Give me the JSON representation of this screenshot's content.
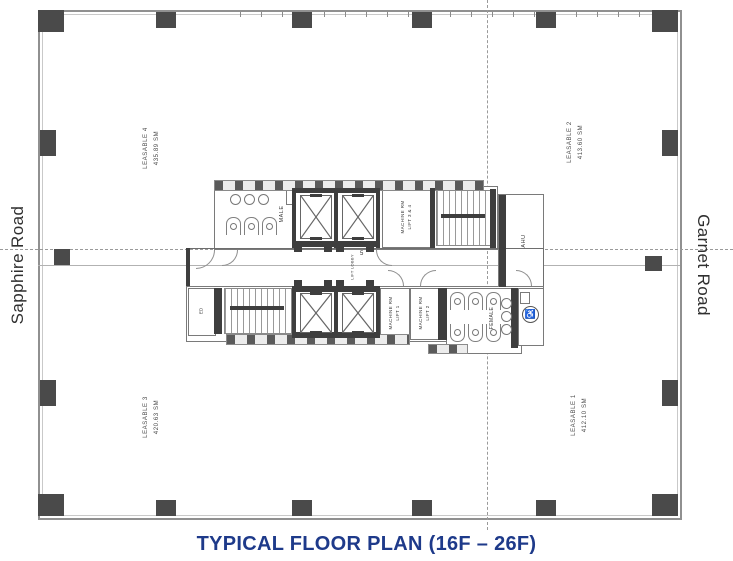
{
  "roads": {
    "left": "Sapphire Road",
    "right": "Garnet Road"
  },
  "title": {
    "text": "TYPICAL FLOOR PLAN (16F – 26F)"
  },
  "quadrants": {
    "top_left": {
      "name": "LEASABLE 4",
      "area": "435.89 SM"
    },
    "top_right": {
      "name": "LEASABLE 2",
      "area": "413.60 SM"
    },
    "bottom_left": {
      "name": "LEASABLE 3",
      "area": "420.63 SM"
    },
    "bottom_right": {
      "name": "LEASABLE 1",
      "area": "412.10 SM"
    }
  },
  "core": {
    "male": "MALE",
    "female": "FEMALE",
    "ahu": "AHU",
    "ed": "ED",
    "lift_lobby": "LIFT LOBBY",
    "stair_number": "5",
    "machine_rm_34": {
      "line1": "MACHINE RM",
      "line2": "LIFT 3 & 4"
    },
    "machine_rm_1": {
      "line1": "MACHINE RM",
      "line2": "LIFT 1"
    },
    "machine_rm_2": {
      "line1": "MACHINE RM",
      "line2": "LIFT 2"
    }
  },
  "colors": {
    "title": "#1e3a8a",
    "road_text": "#2f2f2f",
    "column": "#4a4a4a",
    "wall_line": "#8f8f8f"
  }
}
